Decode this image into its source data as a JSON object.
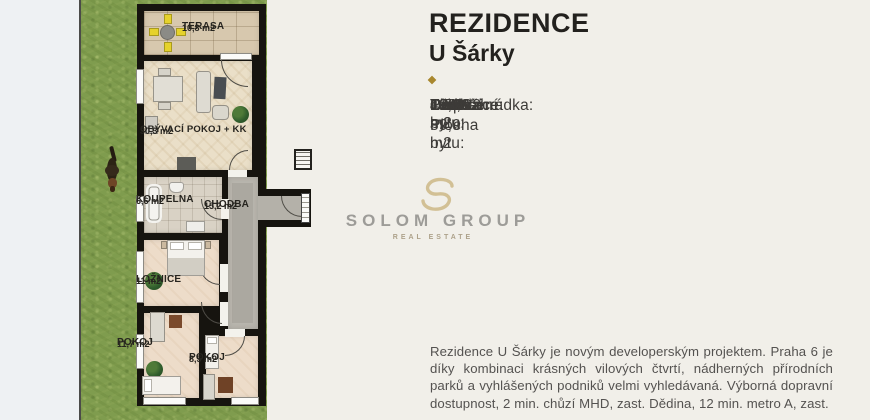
{
  "header": {
    "title_line1": "REZIDENCE",
    "title_line2": "U Šárky"
  },
  "details": [
    {
      "label": "Označení bytu:",
      "value": "106/C2"
    },
    {
      "label": "Podlaží:",
      "value": "1.NP"
    },
    {
      "label": "Orientace:",
      "value": "J/Z/V"
    },
    {
      "label": "Dispozice:",
      "value": "4+KK"
    },
    {
      "label": "Plocha bytu:",
      "value": "89,9 m2"
    },
    {
      "label": "Terasa:",
      "value": "10,8 m2"
    },
    {
      "label": "Předzahrádka:",
      "value": "134,3 m2"
    }
  ],
  "description": "Rezidence U Šárky je novým developerským projektem. Praha 6 je díky kombinaci krásných vilových čtvrtí, nádherných přírodních parků a vyhlášených podniků velmi vyhledávaná. Výborná dopravní dostupnost, 2 min. chůzí MHD, zast. Dědina, 12 min. metro A, zast.",
  "watermark": {
    "name": "SOLOM GROUP",
    "subtitle": "REAL ESTATE"
  },
  "floorplan": {
    "rooms": [
      {
        "name": "TERASA",
        "area": "10,8 m2"
      },
      {
        "name": "OBÝVACÍ POKOJ + KK",
        "area": "30,3 m2"
      },
      {
        "name": "KOUPELNA",
        "area": "6,6 m2"
      },
      {
        "name": "CHODBA",
        "area": "15,2 m2"
      },
      {
        "name": "LOŽNICE",
        "area": "11 m2"
      },
      {
        "name": "POKOJ",
        "area": "11,7 m2"
      },
      {
        "name": "POKOJ",
        "area": "8,5 m2"
      }
    ]
  },
  "colors": {
    "accent_gold": "#a9872e",
    "grass_green": "#7f9c4e",
    "wall_black": "#16140f",
    "background": "#f1efe9",
    "text_dark": "#23211e"
  }
}
